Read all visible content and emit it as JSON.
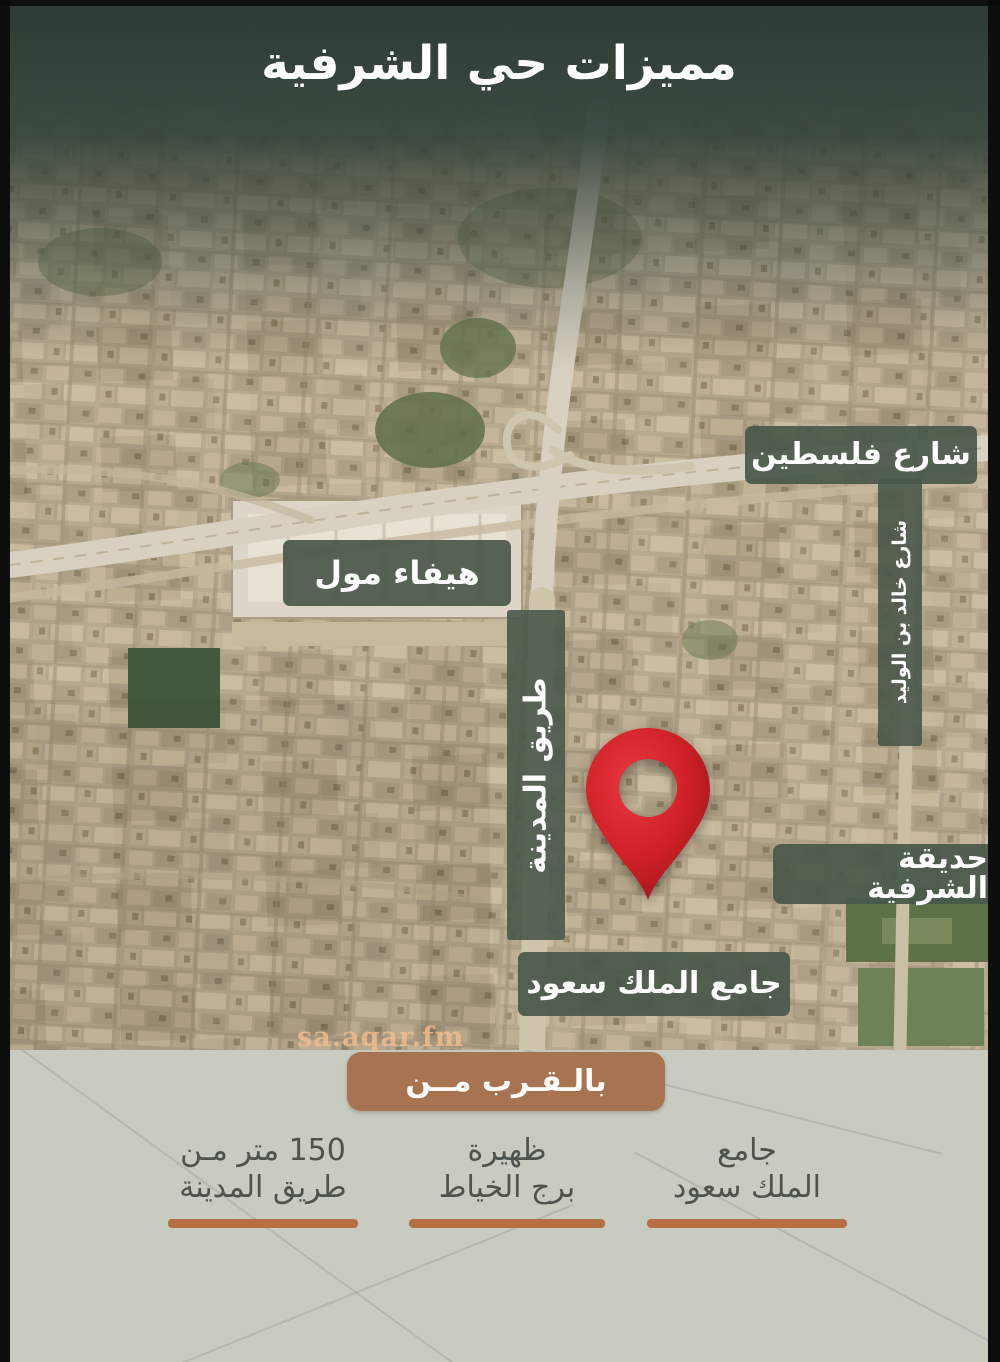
{
  "page": {
    "title": "مميزات حي الشرفية"
  },
  "map": {
    "labels": {
      "palestine_street": "شارع فلسطين",
      "hayfa_mall": "هيفاء مول",
      "madinah_road": "طريق المدينة",
      "khalid_bin_alwaleed_street": "شارع خالد بن الوليد",
      "sharafiyah_park": "حديقة الشرفية",
      "king_saud_mosque": "جامع الملك سعود"
    },
    "marker": "location-pin",
    "watermark": "sa.aqar.fm"
  },
  "nearby": {
    "banner": "بالـقـرب مــن",
    "items": [
      {
        "line1": "جامع",
        "line2": "الملك سعود"
      },
      {
        "line1": "ظهيرة",
        "line2": "برج الخياط"
      },
      {
        "line1": "150 متر مـن",
        "line2": "طريق المدينة"
      }
    ]
  },
  "colors": {
    "header_green": "#36443b",
    "label_green": "#495849",
    "banner_brown": "#a87351",
    "underline_orange": "#b56f42",
    "pin_red": "#d1202a",
    "bottom_bg": "#c8cbc0",
    "bottom_text": "#4c544e",
    "watermark": "#f4bc8c"
  }
}
